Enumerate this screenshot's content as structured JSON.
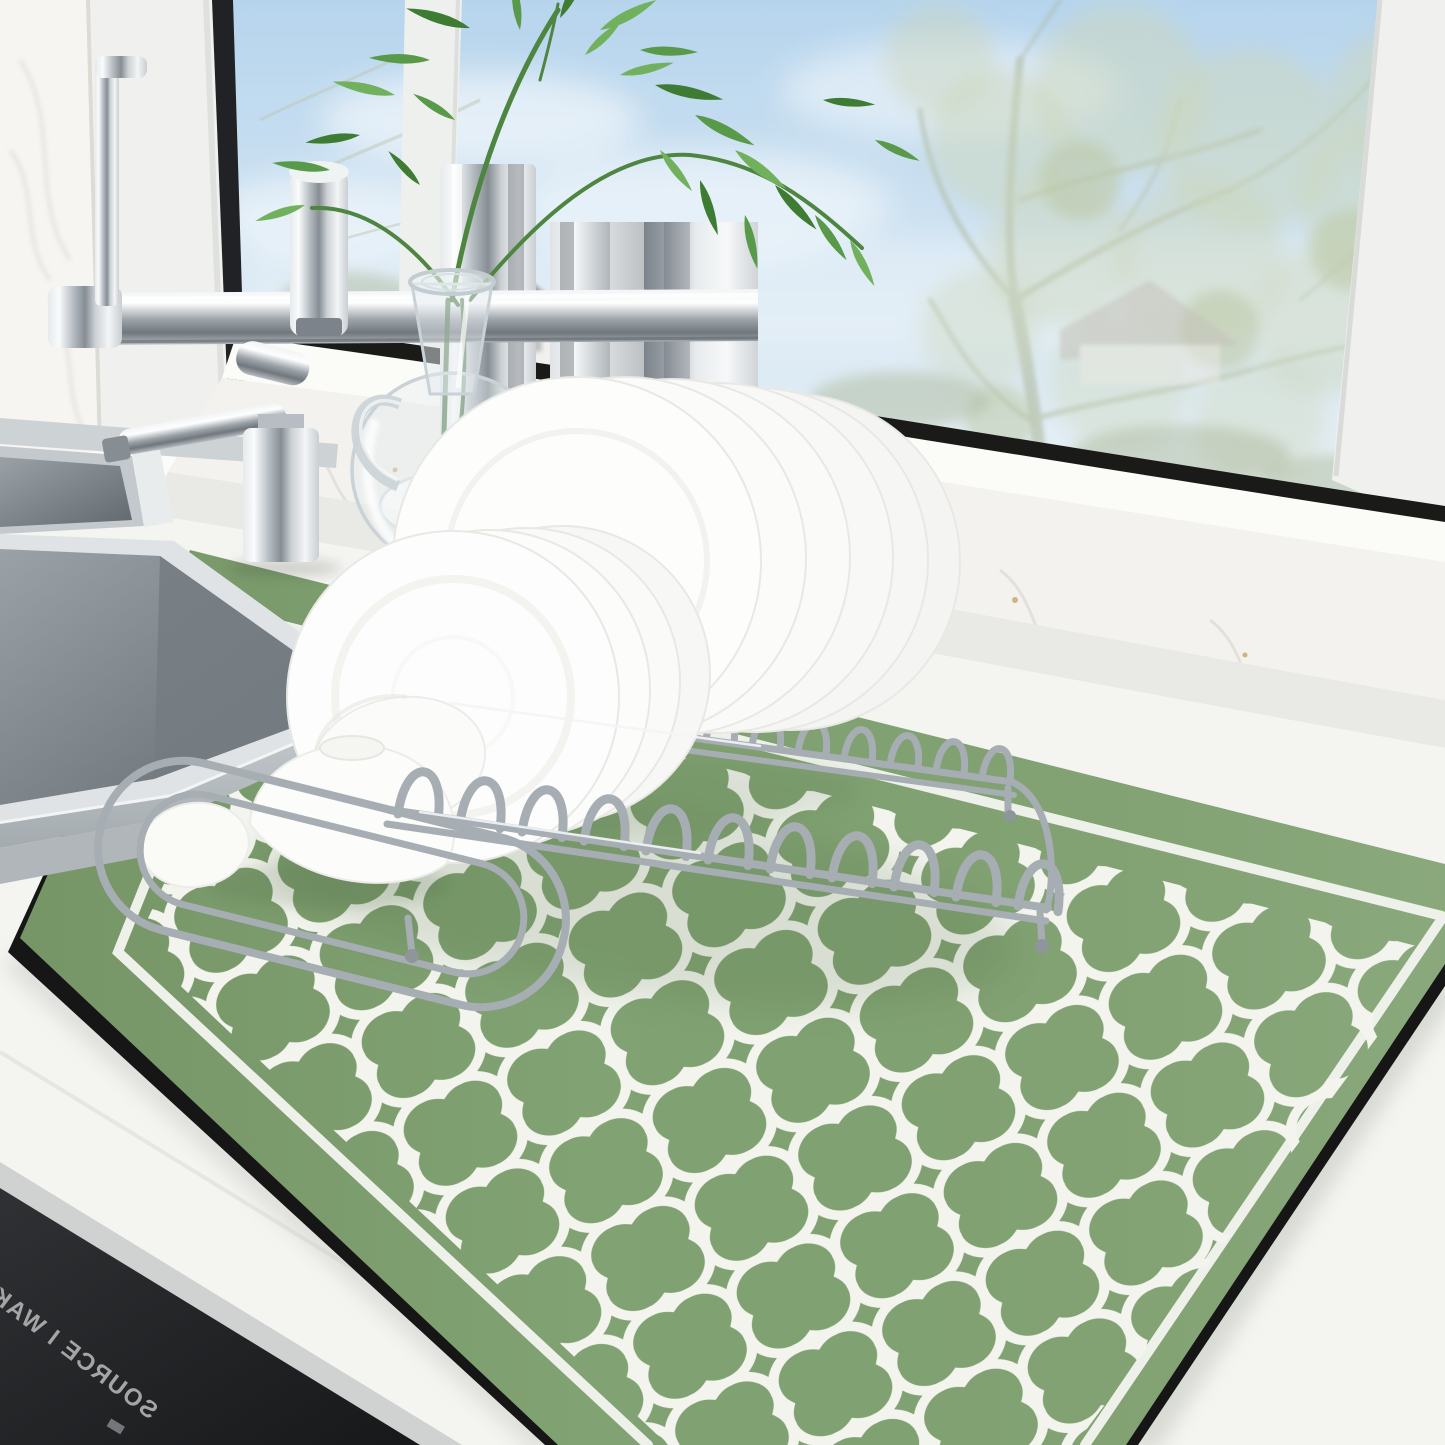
{
  "appliance": {
    "brand_text": "SOURCE I WAKE"
  },
  "palette": {
    "mat_green": "#81a272",
    "mat_pattern_white": "#f2f4ed",
    "mat_trim_black": "#161616",
    "counter_white": "#f4f4f1",
    "sill_bright": "#fbfbf8",
    "marble_white": "#f3f2ee",
    "marble_vein": "#d8d5cd",
    "under_sill_shadow": "#e9e9e5",
    "window_frame_white": "#f0f1ee",
    "window_seal_black": "#1a1a18",
    "sky_top": "#a9cdea",
    "sky_bottom": "#eaf2f6",
    "foliage_distant": "#c3cfae",
    "branch_gray_green": "#9aa687",
    "leaf_dark_green": "#3f7c33",
    "leaf_mid_green": "#59994a",
    "leaf_light_green": "#71b15e",
    "stem_green": "#4e8540",
    "chrome_mid": "#aab1b6",
    "steel_rim": "#dfe3e5",
    "glass_edge": "#c9d2d6",
    "porcelain_white": "#fdfdfc",
    "wire_chrome": "#a6adb3",
    "panel_dark": "#242528",
    "panel_text_gray": "#a3a5a7",
    "counter_edge_gray": "#d0d2d2"
  }
}
